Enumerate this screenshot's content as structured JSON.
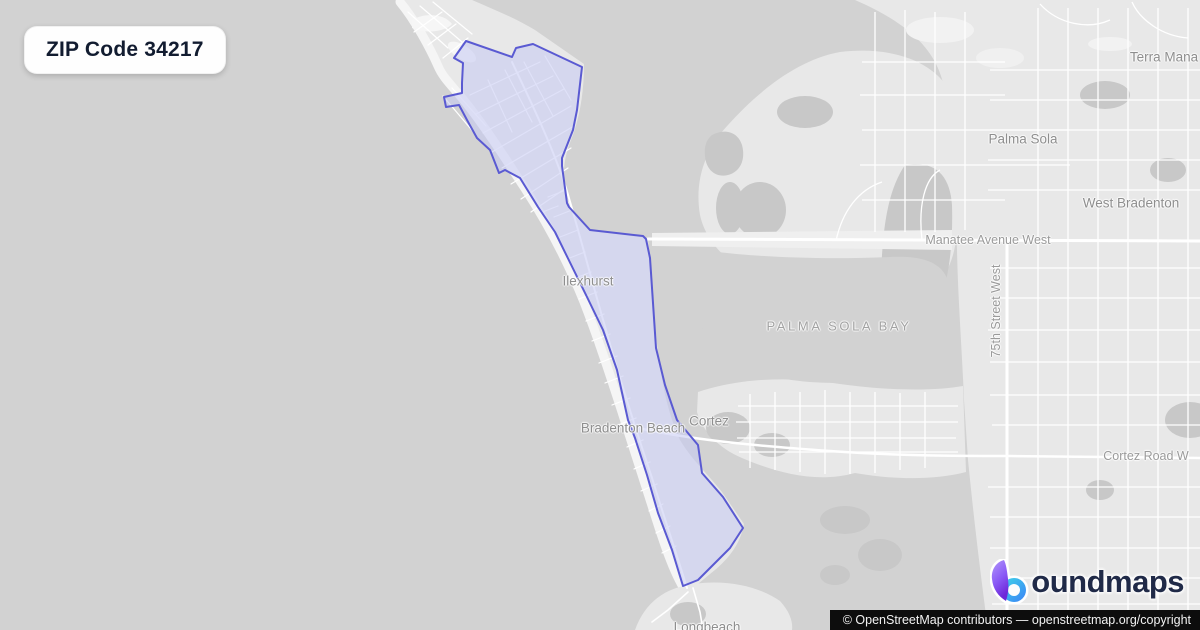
{
  "badge": {
    "label": "ZIP Code 34217"
  },
  "map": {
    "boundary_points": "466,41 512,57 516,48 533,44 582,67 577,110 573,130 562,158 562,166 567,203 569,207 590,230 643,236 646,239 650,258 656,348 665,385 677,420 698,445 702,473 723,497 743,528 730,548 698,580 683,586 672,550 658,513 647,475 635,438 628,420 617,370 603,330 587,297 555,232 538,207 520,178 505,170 499,173 490,150 477,138 467,120 459,105 446,107 444,97 462,93 462,83 463,63 454,58",
    "labels": {
      "terra_mana": "Terra Mana",
      "palma_sola": "Palma Sola",
      "west_bradenton": "West Bradenton",
      "manatee_avenue_west": "Manatee Avenue West",
      "seventy_fifth_street_west": "75th Street West",
      "ilexhurst": "Ilexhurst",
      "palma_sola_bay": "PALMA SOLA BAY",
      "bradenton_beach": "Bradenton Beach",
      "cortez": "Cortez",
      "cortez_road_w": "Cortez Road W",
      "longbeach": "Longbeach"
    },
    "colors": {
      "water": "#d2d2d2",
      "land": "#e8e8e8",
      "land_muted": "#c8c8c8",
      "beach": "#f5f5f5",
      "road": "#ffffff",
      "boundary_stroke": "#5a5ad2",
      "boundary_fill": "#c5c9f2",
      "label_gray": "#8e8e8e"
    }
  },
  "logo": {
    "full_name": "boundmaps",
    "text_after_icon": "oundmaps",
    "icon_purple": "#8b5cf6",
    "icon_cyan": "#3fd6e8",
    "icon_blue": "#3b82f6",
    "wordmark_color": "#202a48"
  },
  "attribution": {
    "text": "© OpenStreetMap contributors — ",
    "link": "openstreetmap.org/copyright"
  }
}
